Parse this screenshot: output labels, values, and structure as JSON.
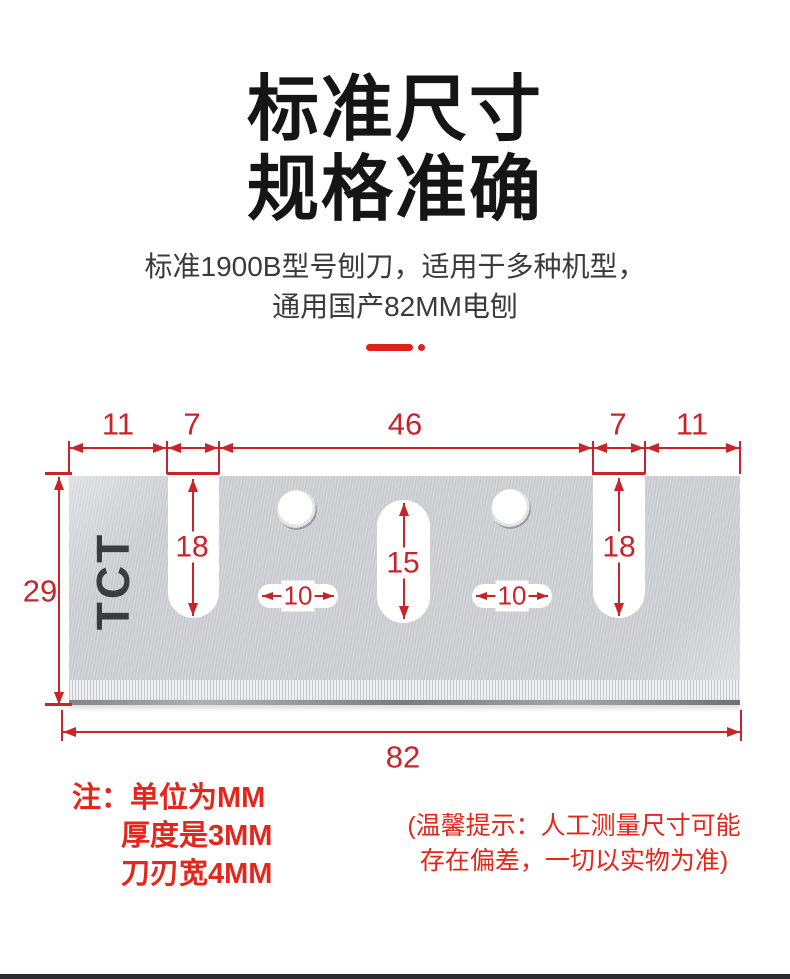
{
  "header": {
    "title_lines": [
      "标准尺寸",
      "规格准确"
    ],
    "subtitle_lines": [
      "标准1900B型号刨刀，适用于多种机型，",
      "通用国产82MM电刨"
    ]
  },
  "diagram": {
    "top_dims": [
      "11",
      "7",
      "46",
      "7",
      "11"
    ],
    "blade_text": "TCT",
    "notch_depth_left": "18",
    "notch_depth_right": "18",
    "center_slot_height": "15",
    "slot_width_left": "10",
    "slot_width_right": "10",
    "blade_height": "29",
    "blade_width": "82"
  },
  "notes": {
    "left_lines": [
      "注：单位为MM",
      "厚度是3MM",
      "刀刃宽4MM"
    ],
    "right_lines": [
      "(温馨提示：人工测量尺寸可能",
      "存在偏差，一切以实物为准)"
    ]
  },
  "colors": {
    "dim_red": "#c8242a",
    "note_red": "#e5261b",
    "accent_red": "#e0201a",
    "blade_gray": "#d0d1d4",
    "title_black": "#151515"
  }
}
